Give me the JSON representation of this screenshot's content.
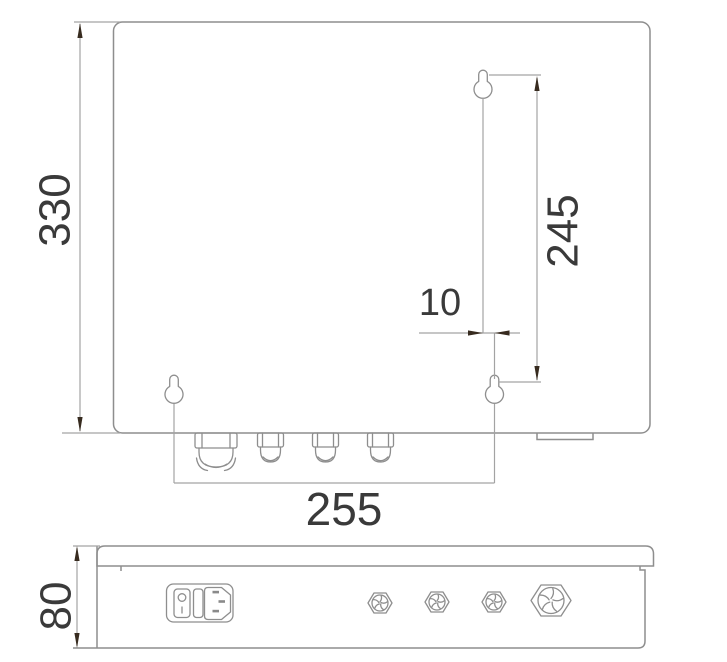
{
  "drawing_title": "enclosure-dimension-drawing",
  "colors": {
    "background": "#ffffff",
    "line": "#8e8e8e",
    "dim_line": "#a3a3a3",
    "arrow": "#372b1f",
    "text": "#3a3a3a"
  },
  "front_view": {
    "dim_height": "330",
    "dim_hole_spacing_vertical": "245",
    "dim_hole_offset_horizontal": "10",
    "dim_hole_spacing_horizontal": "255"
  },
  "side_view": {
    "dim_depth": "80"
  }
}
